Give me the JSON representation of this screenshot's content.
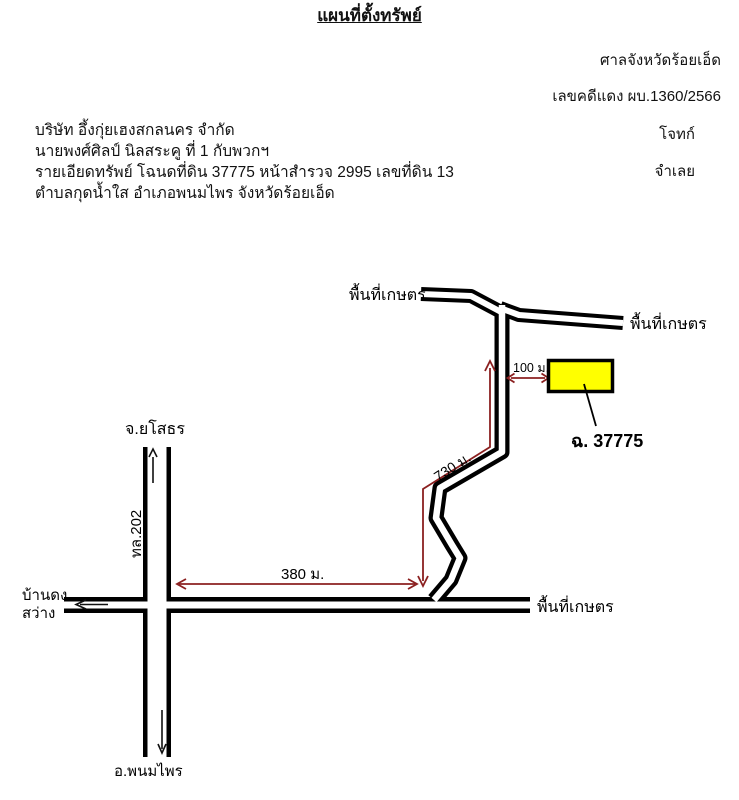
{
  "header": {
    "title": "แผนที่ตั้งทรัพย์",
    "court": "ศาลจังหวัดร้อยเอ็ด",
    "case_no": "เลขคดีแดง ผบ.1360/2566",
    "plaintiff_name": "บริษัท อึ้งกุ่ยเฮงสกลนคร จำกัด",
    "plaintiff_role": "โจทก์",
    "defendant_name": "นายพงศ์ศิลป์  นิลสระคู  ที่ 1 กับพวกฯ",
    "property_detail": "รายเอียดทรัพย์ โฉนดที่ดิน 37775 หน้าสำรวจ 2995 เลขที่ดิน 13",
    "defendant_role": "จำเลย",
    "location_line": "ตำบลกุดน้ำใส  อำเภอพนมไพร  จังหวัดร้อยเอ็ด"
  },
  "map": {
    "labels": {
      "agri_top_left": "พื้นที่เกษตร",
      "agri_top_right": "พื้นที่เกษตร",
      "agri_bottom_right": "พื้นที่เกษตร",
      "yasothon": "จ.ยโสธร",
      "highway_202": "ทล.202",
      "ban_dong": "บ้านดง",
      "sawang": "สว่าง",
      "phanom_phrai": "อ.พนมไพร",
      "parcel": "ฉ. 37775",
      "dist_100": "100 ม.",
      "dist_730": "730 ม.",
      "dist_380": "380 ม."
    },
    "colors": {
      "road_line": "#000000",
      "road_fill": "#ffffff",
      "measure_arrow": "#8B2020",
      "parcel_fill": "#FFFF00",
      "parcel_border": "#000000"
    }
  }
}
